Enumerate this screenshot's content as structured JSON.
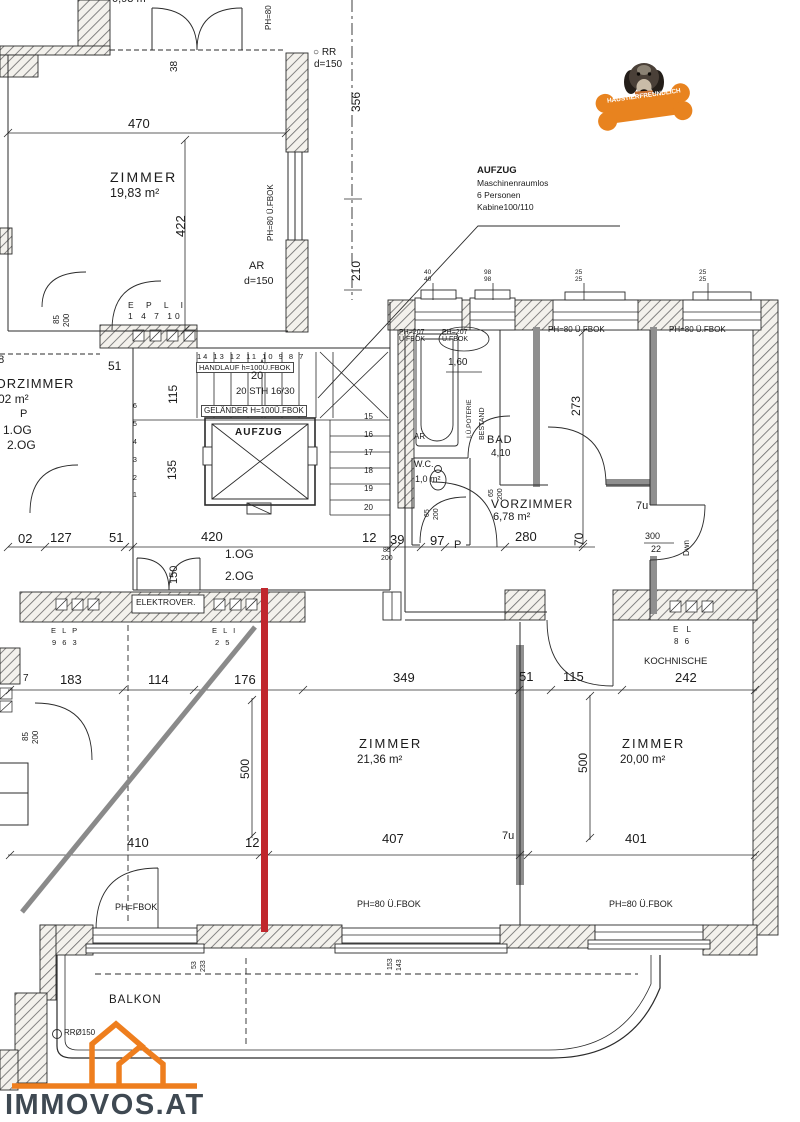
{
  "colors": {
    "accent_orange": "#EE7E1E",
    "marker_red": "#C0272D",
    "marker_gray": "#8A8A8A",
    "logo_text_color": "#3F4952",
    "wall_gray": "#8F8F8F"
  },
  "branding": {
    "logo_text": "IMMOVOS.AT",
    "badge_text": "HAUSTIERFREUNDLICH"
  },
  "elevator_note": {
    "note_title": "AUFZUG",
    "note_line1": "Maschinenraumlos",
    "note_line2": "6 Personen",
    "note_line3": "Kabine100/110"
  },
  "labels": {
    "top_area_cut": "0,93 m²",
    "dim_470": "470",
    "dim_422": "422",
    "zimmer1_name": "ZIMMER",
    "zimmer1_area": "19,83 m²",
    "dim_38": "38",
    "rr_top": "○ RR",
    "rr_top_d": "d=150",
    "dim_356": "356",
    "dim_210": "210",
    "ar_label": "AR",
    "ar_d": "d=150",
    "ph80_window_left": "PH=80 Ü.FBOK",
    "ph80_top_cut": "PH=80",
    "vorzimmer2_name": "VORZIMMER",
    "vorzimmer2_area": "9,02 m²",
    "p_left": "P",
    "og1_left": "1.OG",
    "og2_left": "2.OG",
    "door85_a": "85",
    "door200_a": "200",
    "epli_letters": "E P L I",
    "epli_numbers": "1 4 7 10",
    "dim_51_wall": "51",
    "dim_48": "48",
    "stair_top_numbers": "14 13 12 11 10 9 8 7",
    "handlauf": "HANDLAUF h=100Ü.FBOK",
    "stair_plus20": "20",
    "stair_sth": "20 STH 16/30",
    "gelaender": "GELÄNDER H=100Ü.FBOK",
    "dim_115": "115",
    "dim_135": "135",
    "aufzug_label": "AUFZUG",
    "s15": "15",
    "s16": "16",
    "s17": "17",
    "s18": "18",
    "s19": "19",
    "s20": "20",
    "s6": "6",
    "s5": "5",
    "s4": "4",
    "s3": "3",
    "s2": "2",
    "s1": "1",
    "dim_420_stair": "420",
    "og1_mid": "1.OG",
    "og2_mid": "2.OG",
    "dim_150": "150",
    "elektrover": "ELEKTROVER.",
    "dim_02": "02",
    "dim_127": "127",
    "dim_51_main": "51",
    "dim_12_main": "12",
    "dim_39": "39",
    "dim_97": "97",
    "p_mid": "P",
    "dim_280": "280",
    "dim_70": "70",
    "dim_300": "300",
    "dim_22": "22",
    "dwn": "Dwn",
    "dim_7u_door": "7u",
    "door85_b": "85",
    "door200_b": "200",
    "ph207_a": "PH=207\nÜ.FBOK",
    "ph207_b": "PH=207\nÜ.FBOK",
    "ph80_top_a": "PH=80 Ü.FBOK",
    "ph80_top_b": "PH=80 Ü.FBOK",
    "win_pair_1": "40\n40",
    "win_pair_2": "98\n98",
    "win_pair_3": "25\n25",
    "win_pair_4": "25\n25",
    "dim_160": "1,60",
    "poterie": "I.Ü.POTERIE",
    "bestand": "BESTAND",
    "bad_name": "BAD",
    "bad_area": "4,10",
    "wc_ar": "AR",
    "wc_name": "W.C.",
    "wc_area": "1,0 m²",
    "wc_65": "65",
    "wc_200": "200",
    "bad_65": "65",
    "bad_200": "200",
    "dim_273": "273",
    "vorzimmer1_name": "VORZIMMER",
    "vorzimmer1_area": "6,78 m²",
    "kochnische_name": "KOCHNISCHE",
    "dim_242": "242",
    "el_letters_c": "E L",
    "el_numbers_c": "8 6",
    "dim_183": "183",
    "dim_114": "114",
    "dim_176": "176",
    "dim_349": "349",
    "dim_51_low": "51",
    "dim_115_low": "115",
    "dim_7_low": "7",
    "elp_letters": "E L P",
    "elp_numbers": "9 6 3",
    "eli_letters": "E L I",
    "eli_numbers": "2 5",
    "zimmer2_name": "ZIMMER",
    "zimmer2_area": "21,36 m²",
    "zimmer3_name": "ZIMMER",
    "zimmer3_area": "20,00 m²",
    "dim_500_l": "500",
    "dim_500_r": "500",
    "door85_c": "85",
    "door200_c": "200",
    "dim_410": "410",
    "dim_12_low": "12",
    "dim_407": "407",
    "dim_7u_low": "7u",
    "dim_401": "401",
    "ph_fbok": "PH=FBOK",
    "ph80_bottom_a": "PH=80 Ü.FBOK",
    "ph80_bottom_b": "PH=80 Ü.FBOK",
    "win_53": "53",
    "win_233": "233",
    "win_153": "153",
    "win_143": "143",
    "balkon": "BALKON",
    "rr150": "RRØ150"
  }
}
